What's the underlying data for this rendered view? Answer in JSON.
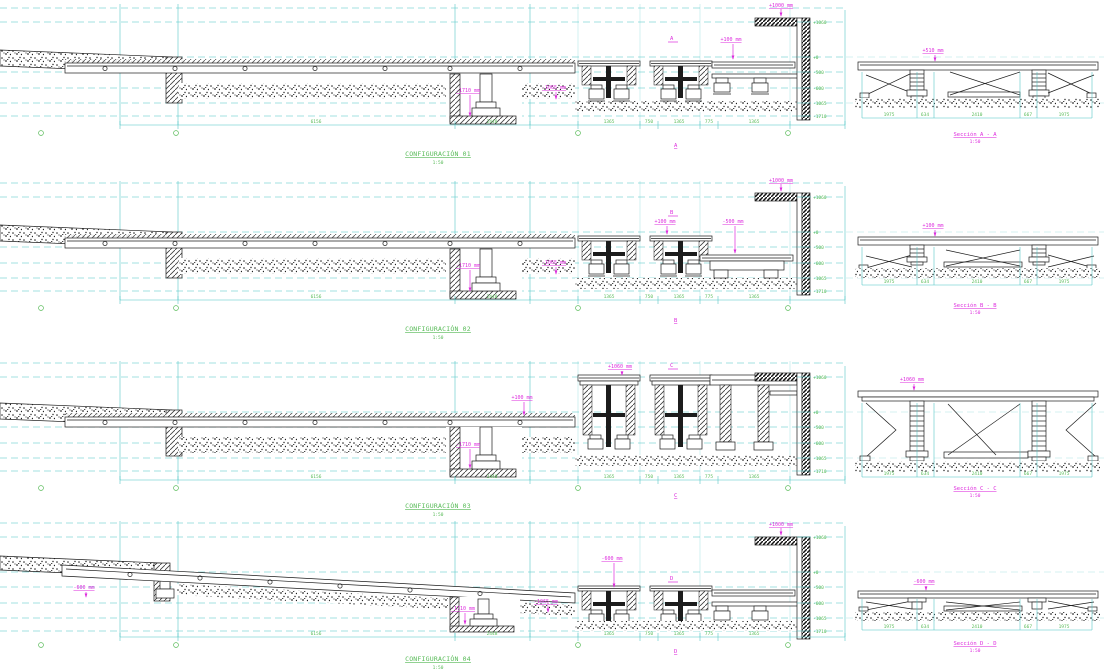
{
  "drawing": {
    "configs": [
      {
        "title": "CONFIGURACIÓN 01",
        "scale": "1:50",
        "cut": "A",
        "labels": {
          "wall_top": "+1000 mm",
          "deck": "+100 mm",
          "pit": "-1710 mm",
          "subfloor": "-1065 mm"
        },
        "elevations": [
          "+1060",
          "+0",
          "-500",
          "-600",
          "-1065",
          "-1710"
        ],
        "dims": [
          "6156",
          "2448",
          "1365",
          "750",
          "1365",
          "775",
          "1365"
        ]
      },
      {
        "title": "CONFIGURACIÓN 02",
        "scale": "1:50",
        "cut": "B",
        "labels": {
          "wall_top": "+1000 mm",
          "deck": "+100 mm",
          "bench": "-500 mm",
          "pit": "-1710 mm",
          "subfloor": "-1065 mm"
        },
        "elevations": [
          "+1060",
          "+0",
          "-500",
          "-600",
          "-1065",
          "-1710"
        ],
        "dims": [
          "6156",
          "2448",
          "1365",
          "750",
          "1365",
          "775",
          "1365"
        ]
      },
      {
        "title": "CONFIGURACIÓN 03",
        "scale": "1:50",
        "cut": "C",
        "labels": {
          "deck": "+1060 mm",
          "street": "+100 mm",
          "pit": "-1710 mm"
        },
        "elevations": [
          "+1060",
          "+0",
          "-500",
          "-600",
          "-1065",
          "-1710"
        ],
        "dims": [
          "6156",
          "2448",
          "1365",
          "750",
          "1365",
          "775",
          "1365"
        ]
      },
      {
        "title": "CONFIGURACIÓN 04",
        "scale": "1:50",
        "cut": "D",
        "labels": {
          "wall_top": "+1000 mm",
          "ramp": "-600 mm",
          "edge": "-600 mm",
          "pit": "-1710 mm",
          "subfloor": "-1065 mm"
        },
        "elevations": [
          "+1060",
          "+0",
          "-500",
          "-600",
          "-1065",
          "-1710"
        ],
        "dims": [
          "6156",
          "2448",
          "1365",
          "750",
          "1365",
          "775",
          "1365"
        ]
      }
    ],
    "sections": [
      {
        "title": "Sección A - A",
        "scale": "1:50",
        "level": "+510 mm",
        "dims": [
          "1975",
          "634",
          "2410",
          "667",
          "1975"
        ]
      },
      {
        "title": "Sección B - B",
        "scale": "1:50",
        "level": "+100 mm",
        "dims": [
          "1975",
          "634",
          "2410",
          "667",
          "1975"
        ]
      },
      {
        "title": "Sección C - C",
        "scale": "1:50",
        "level": "+1060 mm",
        "dims": [
          "1975",
          "634",
          "2410",
          "667",
          "1975"
        ]
      },
      {
        "title": "Sección D - D",
        "scale": "1:50",
        "level": "-600 mm",
        "dims": [
          "1975",
          "634",
          "2410",
          "667",
          "1975"
        ]
      }
    ]
  }
}
